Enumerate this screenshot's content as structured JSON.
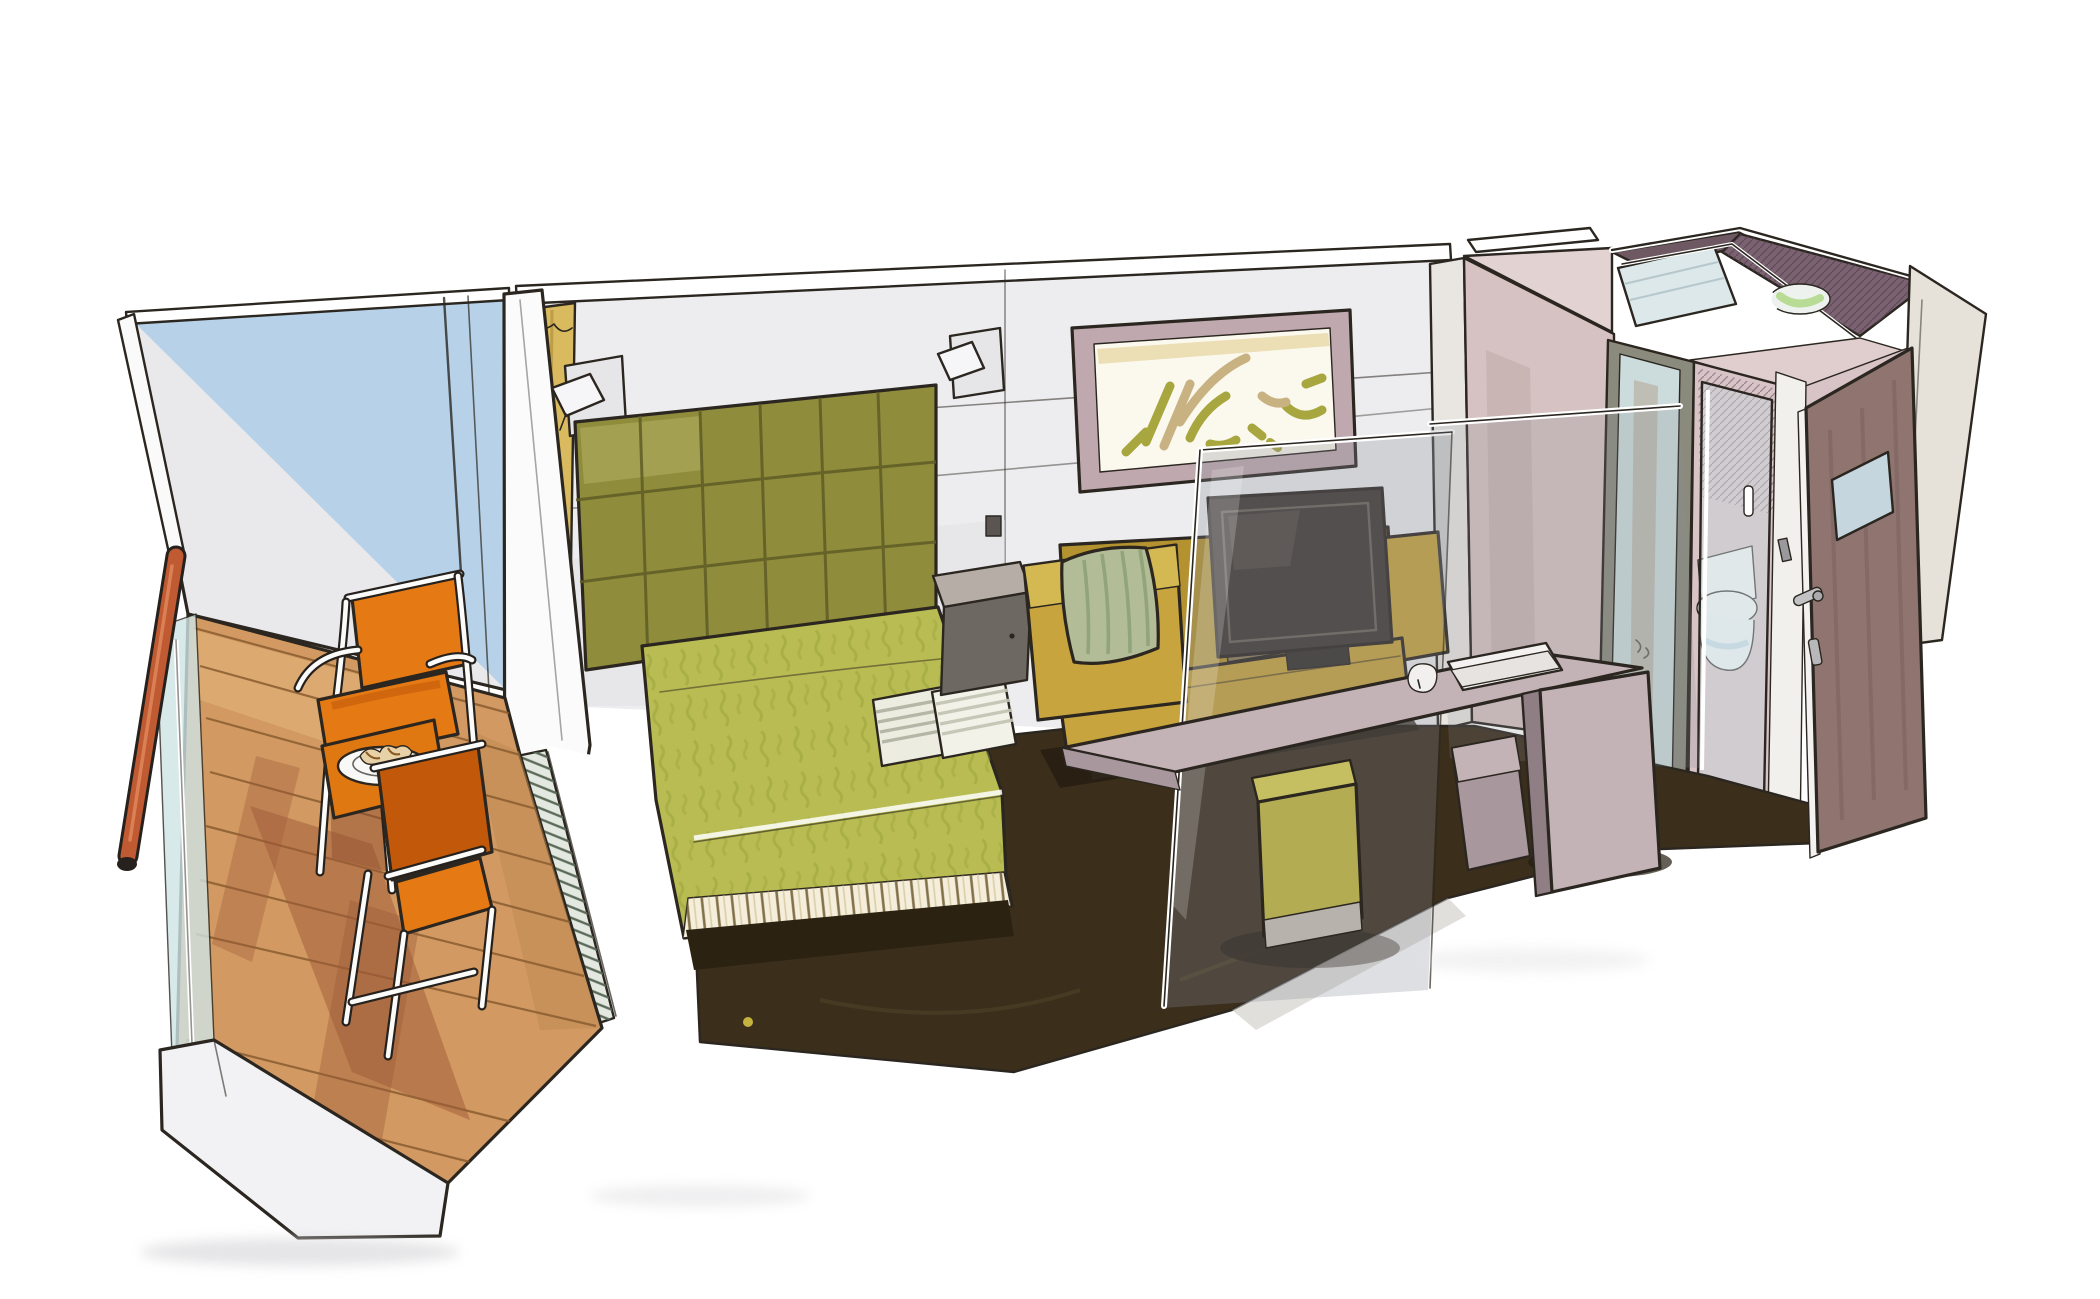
{
  "illustration": {
    "subject": "cabin-cutaway-sketch",
    "areas": {
      "balcony": [
        "sky-wall",
        "handrail",
        "glass-balustrade",
        "teak-deck",
        "deck-chair",
        "deck-chair",
        "bistro-table",
        "breakfast-plate"
      ],
      "bedroom": [
        "curtain",
        "reading-lamp",
        "tufted-headboard",
        "double-bed",
        "bed-skirt",
        "striped-pillows",
        "nightstand",
        "wall-art",
        "reading-lamp"
      ],
      "lounge": [
        "sofa",
        "arm-cushion",
        "tv-screen",
        "glass-divider",
        "desk",
        "paper-folder",
        "pouf-stool"
      ],
      "bathroom": [
        "wardrobe",
        "corridor-mirror",
        "shower-glass-door",
        "toilet",
        "washbasin-top",
        "bathroom-door",
        "entry-wall"
      ]
    }
  },
  "palette": {
    "paper": "#ffffff",
    "ink": "#2b2620",
    "wall_grey": "#ededef",
    "wall_shade": "#dcdce0",
    "sky_blue": "#b7d2e8",
    "deck_tan": "#d29a62",
    "deck_shadow": "#9e5a38",
    "handrail": "#c05a32",
    "balustrade_glass": "#cfe4e6",
    "chair_orange": "#e57a14",
    "chair_orange_deep": "#c2590a",
    "table_orange": "#e07812",
    "plate_white": "#f8f8f6",
    "partition_white": "#fafafa",
    "curtain_gold": "#d9ba5e",
    "headboard_olive": "#8f8c3c",
    "spread_green": "#b9bc52",
    "skirt_cream": "#f4eeda",
    "pillow_cream": "#ecece0",
    "floor_brown": "#3b2f1c",
    "nightstand_grey": "#6e6862",
    "nightstand_top": "#b6aea6",
    "sofa_mustard": "#c8a43e",
    "cushion_sage": "#b2bc96",
    "tv_dark": "#3f3833",
    "glass_tint": "#8a8c96",
    "desk_mauve": "#c3b2b6",
    "desk_mauve_dark": "#a8979c",
    "pouf_olive": "#b3ac52",
    "art_frame": "#bfa8ae",
    "art_canvas": "#fbf8ee",
    "art_olive": "#a8a63f",
    "art_tan": "#c8b282",
    "closet_pink": "#d6c2c2",
    "closet_top": "#e2d2d2",
    "plum_dark": "#6e5862",
    "plum_mid": "#7a6270",
    "skylight_blue": "#dce8ea",
    "mirror_blue": "#ccdcdc",
    "bathroom_pink": "#d8c4c6",
    "toilet_white": "#f4f6f6",
    "door_brown": "#8f7470",
    "door_window": "#c6d6de",
    "entry_wall": "#e6e2da",
    "threshold": "#e3e9e0"
  }
}
